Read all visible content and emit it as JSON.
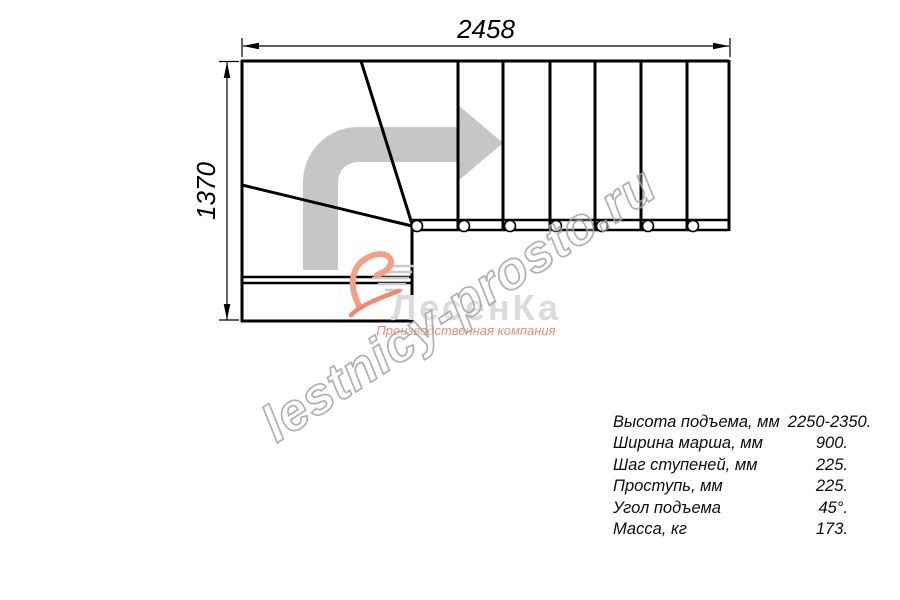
{
  "drawing": {
    "top_dimension": "2458",
    "left_dimension": "1370",
    "type": "staircase-plan-quarter-turn",
    "straight_steps": 7,
    "winder_steps": 3
  },
  "specs": {
    "rows": [
      {
        "label": "Высота подъема, мм",
        "value": "2250-2350."
      },
      {
        "label": "Ширина марша, мм",
        "value": "900."
      },
      {
        "label": "Шаг ступеней, мм",
        "value": "225."
      },
      {
        "label": "Проступь, мм",
        "value": "225."
      },
      {
        "label": "Угол подъема",
        "value": "45°."
      },
      {
        "label": "Масса, кг",
        "value": "173."
      }
    ]
  },
  "logo": {
    "name": "ЛесенКа",
    "tagline": "Производственная компания"
  },
  "watermark": {
    "text": "lestnicy-prosto.ru"
  },
  "colors": {
    "line": "#000000",
    "direction_arrow": "#c6c6c6",
    "logo_accent": "#ee8d7b",
    "logo_gray": "#dbdbdb",
    "watermark_stroke": "#a3a3a3"
  }
}
